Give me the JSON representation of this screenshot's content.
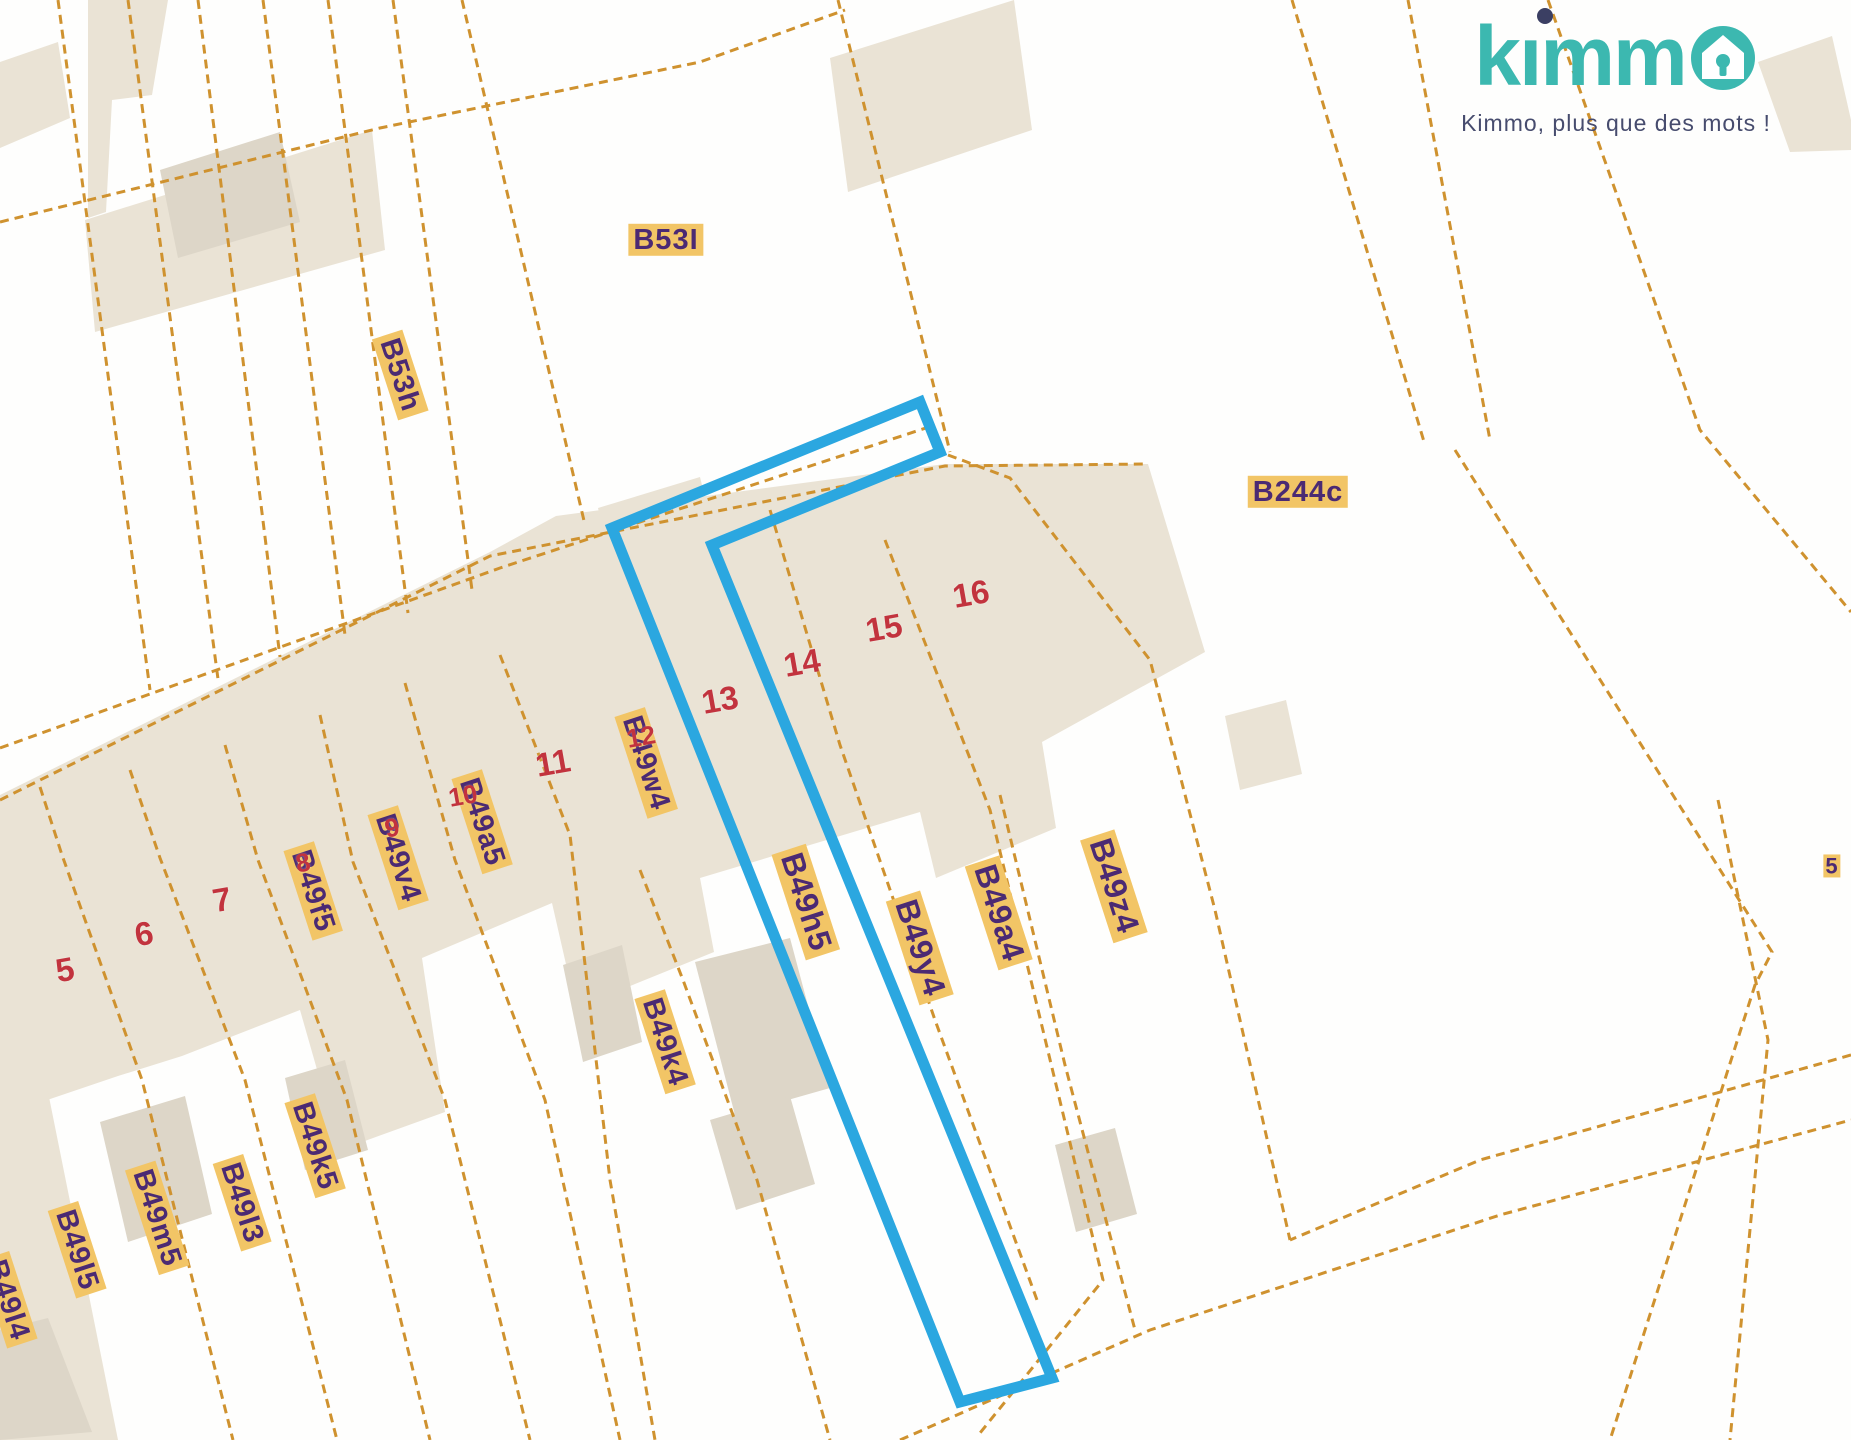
{
  "brand": {
    "logo_text": "kımm",
    "tagline": "Kimmo, plus que des mots !"
  },
  "map": {
    "parcel_labels": [
      {
        "text": "B53I"
      },
      {
        "text": "B53h"
      },
      {
        "text": "B244c"
      },
      {
        "text": "B49w4"
      },
      {
        "text": "B49a5"
      },
      {
        "text": "B49v4"
      },
      {
        "text": "B49f5"
      },
      {
        "text": "B49h5"
      },
      {
        "text": "B49y4"
      },
      {
        "text": "B49a4"
      },
      {
        "text": "B49z4"
      },
      {
        "text": "B49k4"
      },
      {
        "text": "B49k5"
      },
      {
        "text": "B49l3"
      },
      {
        "text": "B49m5"
      },
      {
        "text": "B49l5"
      },
      {
        "text": "B49l4"
      },
      {
        "text": "5"
      }
    ],
    "lot_numbers": [
      {
        "text": "5"
      },
      {
        "text": "6"
      },
      {
        "text": "7"
      },
      {
        "text": "8"
      },
      {
        "text": "9"
      },
      {
        "text": "10"
      },
      {
        "text": "11"
      },
      {
        "text": "12"
      },
      {
        "text": "13"
      },
      {
        "text": "14"
      },
      {
        "text": "15"
      },
      {
        "text": "16"
      }
    ]
  },
  "colors": {
    "selection_blue": "#2ba7e0",
    "parcel_line_orange": "#cf922f",
    "parcel_fill_beige": "#eae3d5",
    "building_fill": "#ddd6c8",
    "label_background": "#f2c566",
    "label_text_purple": "#4b2a73",
    "lot_number_red": "#c2333e",
    "brand_teal": "#3cb8b0",
    "brand_dark_navy": "#3b3f63"
  }
}
